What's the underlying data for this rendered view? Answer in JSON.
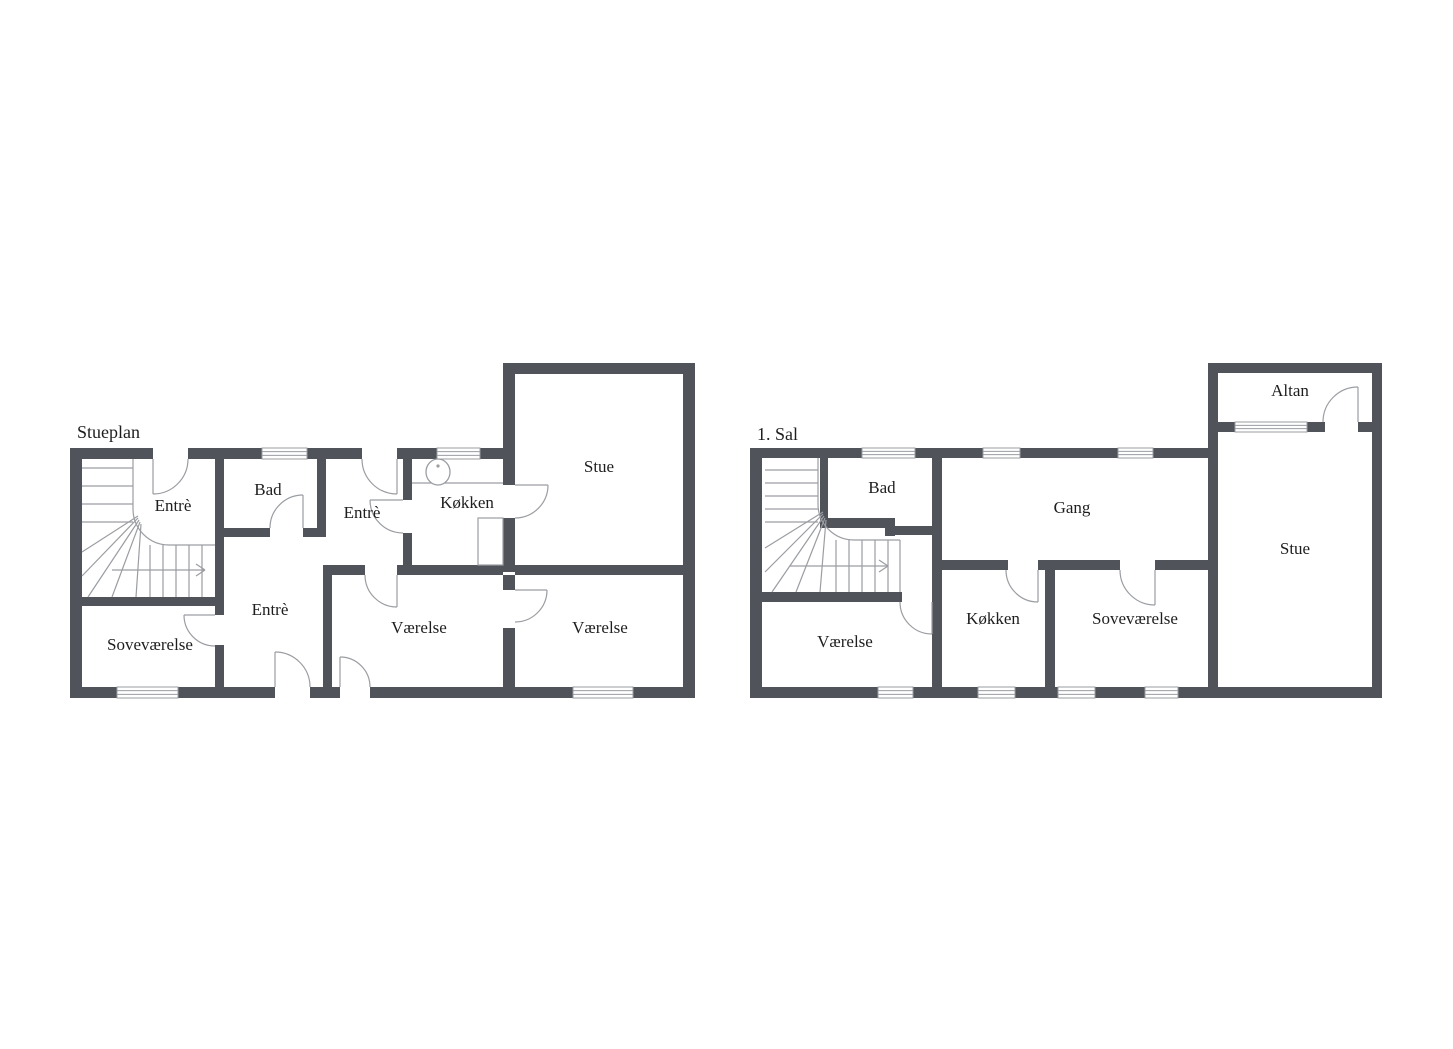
{
  "document": {
    "type": "floor-plan-sheet",
    "background": "#ffffff"
  },
  "colors": {
    "wall": "#50535a",
    "thin": "#9a9da2",
    "text": "#1e1e1e",
    "fill": "#ffffff"
  },
  "plans": [
    {
      "id": "stueplan",
      "title": "Stueplan",
      "title_pos": [
        77,
        438
      ],
      "title_size": 18,
      "label_size": 17,
      "labels": [
        {
          "text": "Entrè",
          "x": 173,
          "y": 507
        },
        {
          "text": "Bad",
          "x": 268,
          "y": 491
        },
        {
          "text": "Entrè",
          "x": 362,
          "y": 514
        },
        {
          "text": "Køkken",
          "x": 467,
          "y": 504
        },
        {
          "text": "Stue",
          "x": 599,
          "y": 468
        },
        {
          "text": "Soveværelse",
          "x": 150,
          "y": 646
        },
        {
          "text": "Entrè",
          "x": 270,
          "y": 611
        },
        {
          "text": "Værelse",
          "x": 419,
          "y": 629
        },
        {
          "text": "Værelse",
          "x": 600,
          "y": 629
        }
      ],
      "walls": [
        [
          70,
          448,
          12,
          250
        ],
        [
          70,
          448,
          83,
          11
        ],
        [
          188,
          448,
          74,
          11
        ],
        [
          307,
          448,
          55,
          11
        ],
        [
          397,
          448,
          40,
          11
        ],
        [
          480,
          448,
          35,
          11
        ],
        [
          503,
          363,
          12,
          122
        ],
        [
          503,
          518,
          12,
          54
        ],
        [
          503,
          363,
          192,
          11
        ],
        [
          683,
          363,
          12,
          335
        ],
        [
          70,
          687,
          47,
          11
        ],
        [
          178,
          687,
          97,
          11
        ],
        [
          310,
          687,
          30,
          11
        ],
        [
          370,
          687,
          203,
          11
        ],
        [
          633,
          687,
          62,
          11
        ],
        [
          215,
          459,
          9,
          146
        ],
        [
          215,
          605,
          9,
          10
        ],
        [
          215,
          645,
          9,
          42
        ],
        [
          70,
          597,
          154,
          9
        ],
        [
          215,
          528,
          55,
          9
        ],
        [
          303,
          528,
          22,
          9
        ],
        [
          317,
          459,
          9,
          78
        ],
        [
          323,
          565,
          42,
          10
        ],
        [
          397,
          565,
          106,
          10
        ],
        [
          515,
          565,
          168,
          10
        ],
        [
          323,
          565,
          9,
          122
        ],
        [
          503,
          575,
          12,
          15
        ],
        [
          503,
          628,
          12,
          59
        ],
        [
          403,
          459,
          9,
          41
        ],
        [
          403,
          533,
          9,
          32
        ]
      ],
      "windows": [
        [
          262,
          448,
          45,
          11
        ],
        [
          437,
          448,
          43,
          11
        ],
        [
          117,
          687,
          61,
          11
        ],
        [
          573,
          687,
          60,
          11
        ]
      ],
      "door_arcs": [
        "M 153 494 A 35 35 0 0 0 188 459",
        "M 303 495 A 33 33 0 0 0 270 528",
        "M 397 494 A 35 35 0 0 1 362 459",
        "M 370 500 A 33 33 0 0 0 403 533",
        "M 548 485 A 33 33 0 0 1 515 518",
        "M 184 615 A 31 31 0 0 0 215 646",
        "M 275 652 A 35 35 0 0 1 310 687",
        "M 340 657 A 30 30 0 0 1 370 687",
        "M 397 607 A 32 32 0 0 1 365 575",
        "M 547 590 A 32 32 0 0 1 515 622"
      ],
      "door_leaves": [
        [
          153,
          459,
          153,
          494
        ],
        [
          303,
          528,
          303,
          495
        ],
        [
          397,
          459,
          397,
          494
        ],
        [
          403,
          500,
          370,
          500
        ],
        [
          515,
          485,
          548,
          485
        ],
        [
          215,
          615,
          184,
          615
        ],
        [
          275,
          687,
          275,
          652
        ],
        [
          340,
          687,
          340,
          657
        ],
        [
          397,
          575,
          397,
          607
        ],
        [
          515,
          590,
          547,
          590
        ]
      ],
      "stair_lines": [
        [
          82,
          468,
          133,
          468
        ],
        [
          82,
          486,
          133,
          486
        ],
        [
          82,
          504,
          133,
          504
        ],
        [
          82,
          522,
          133,
          522
        ],
        [
          133,
          459,
          133,
          509
        ],
        [
          169,
          545,
          215,
          545
        ],
        [
          150,
          545,
          150,
          597
        ],
        [
          163,
          545,
          163,
          597
        ],
        [
          176,
          545,
          176,
          597
        ],
        [
          189,
          545,
          189,
          597
        ],
        [
          202,
          545,
          202,
          597
        ],
        [
          138,
          516,
          82,
          552
        ],
        [
          138,
          518,
          82,
          576
        ],
        [
          139,
          520,
          88,
          597
        ],
        [
          140,
          522,
          112,
          597
        ],
        [
          141,
          524,
          136,
          597
        ]
      ],
      "stair_paths": [
        "M 133 509 A 36 36 0 0 0 169 545"
      ],
      "arrow_lines": [
        [
          112,
          570,
          205,
          570
        ],
        [
          196,
          564,
          205,
          570
        ],
        [
          196,
          576,
          205,
          570
        ]
      ],
      "fixture_lines": [
        [
          412,
          483,
          503,
          483
        ]
      ],
      "fixture_rects": [
        [
          478,
          518,
          25,
          47
        ]
      ],
      "sink": {
        "cx": 438,
        "cy": 472,
        "rx": 12,
        "ry": 13,
        "dot": [
          438,
          466,
          1.6
        ]
      }
    },
    {
      "id": "foerste-sal",
      "title": "1. Sal",
      "title_pos": [
        757,
        440
      ],
      "title_size": 18,
      "label_size": 17,
      "labels": [
        {
          "text": "Altan",
          "x": 1290,
          "y": 392
        },
        {
          "text": "Bad",
          "x": 882,
          "y": 489
        },
        {
          "text": "Gang",
          "x": 1072,
          "y": 509
        },
        {
          "text": "Stue",
          "x": 1295,
          "y": 550
        },
        {
          "text": "Værelse",
          "x": 845,
          "y": 643
        },
        {
          "text": "Køkken",
          "x": 993,
          "y": 620
        },
        {
          "text": "Soveværelse",
          "x": 1135,
          "y": 620
        }
      ],
      "walls": [
        [
          750,
          448,
          12,
          250
        ],
        [
          750,
          448,
          112,
          10
        ],
        [
          915,
          448,
          68,
          10
        ],
        [
          1020,
          448,
          98,
          10
        ],
        [
          1153,
          448,
          55,
          10
        ],
        [
          1208,
          363,
          10,
          324
        ],
        [
          1208,
          363,
          174,
          10
        ],
        [
          1372,
          363,
          10,
          335
        ],
        [
          1218,
          422,
          17,
          10
        ],
        [
          1307,
          422,
          18,
          10
        ],
        [
          1358,
          422,
          14,
          10
        ],
        [
          750,
          687,
          128,
          11
        ],
        [
          913,
          687,
          65,
          11
        ],
        [
          1015,
          687,
          43,
          11
        ],
        [
          1095,
          687,
          50,
          11
        ],
        [
          1178,
          687,
          204,
          11
        ],
        [
          750,
          592,
          152,
          10
        ],
        [
          932,
          458,
          10,
          229
        ],
        [
          820,
          458,
          8,
          70
        ],
        [
          820,
          518,
          70,
          10
        ],
        [
          885,
          518,
          10,
          18
        ],
        [
          885,
          526,
          50,
          9
        ],
        [
          942,
          560,
          66,
          10
        ],
        [
          1038,
          560,
          82,
          10
        ],
        [
          1155,
          560,
          53,
          10
        ],
        [
          1045,
          560,
          10,
          127
        ]
      ],
      "windows": [
        [
          862,
          448,
          53,
          10
        ],
        [
          983,
          448,
          37,
          10
        ],
        [
          1118,
          448,
          35,
          10
        ],
        [
          1235,
          422,
          72,
          10
        ],
        [
          878,
          687,
          35,
          11
        ],
        [
          978,
          687,
          37,
          11
        ],
        [
          1058,
          687,
          37,
          11
        ],
        [
          1145,
          687,
          33,
          11
        ]
      ],
      "door_arcs": [
        "M 1358 387 A 35 35 0 0 0 1323 422",
        "M 932 634 A 32 32 0 0 1 900 602",
        "M 1038 602 A 32 32 0 0 1 1006 570",
        "M 1155 605 A 35 35 0 0 1 1120 570"
      ],
      "door_leaves": [
        [
          1358,
          422,
          1358,
          387
        ],
        [
          932,
          602,
          932,
          634
        ],
        [
          1038,
          570,
          1038,
          602
        ],
        [
          1155,
          570,
          1155,
          605
        ]
      ],
      "stair_lines": [
        [
          765,
          470,
          818,
          470
        ],
        [
          765,
          483,
          818,
          483
        ],
        [
          765,
          496,
          818,
          496
        ],
        [
          765,
          509,
          818,
          509
        ],
        [
          765,
          522,
          818,
          522
        ],
        [
          818,
          458,
          818,
          504
        ],
        [
          854,
          540,
          900,
          540
        ],
        [
          900,
          540,
          900,
          592
        ],
        [
          836,
          540,
          836,
          592
        ],
        [
          849,
          540,
          849,
          592
        ],
        [
          862,
          540,
          862,
          592
        ],
        [
          875,
          540,
          875,
          592
        ],
        [
          888,
          540,
          888,
          592
        ],
        [
          823,
          512,
          765,
          548
        ],
        [
          823,
          514,
          765,
          572
        ],
        [
          824,
          516,
          772,
          592
        ],
        [
          825,
          518,
          796,
          592
        ],
        [
          826,
          520,
          820,
          592
        ]
      ],
      "stair_paths": [
        "M 818 504 A 36 36 0 0 0 854 540"
      ],
      "arrow_lines": [
        [
          790,
          566,
          888,
          566
        ],
        [
          879,
          560,
          888,
          566
        ],
        [
          879,
          572,
          888,
          566
        ]
      ],
      "fixture_lines": [],
      "fixture_rects": [],
      "sink": null
    }
  ]
}
